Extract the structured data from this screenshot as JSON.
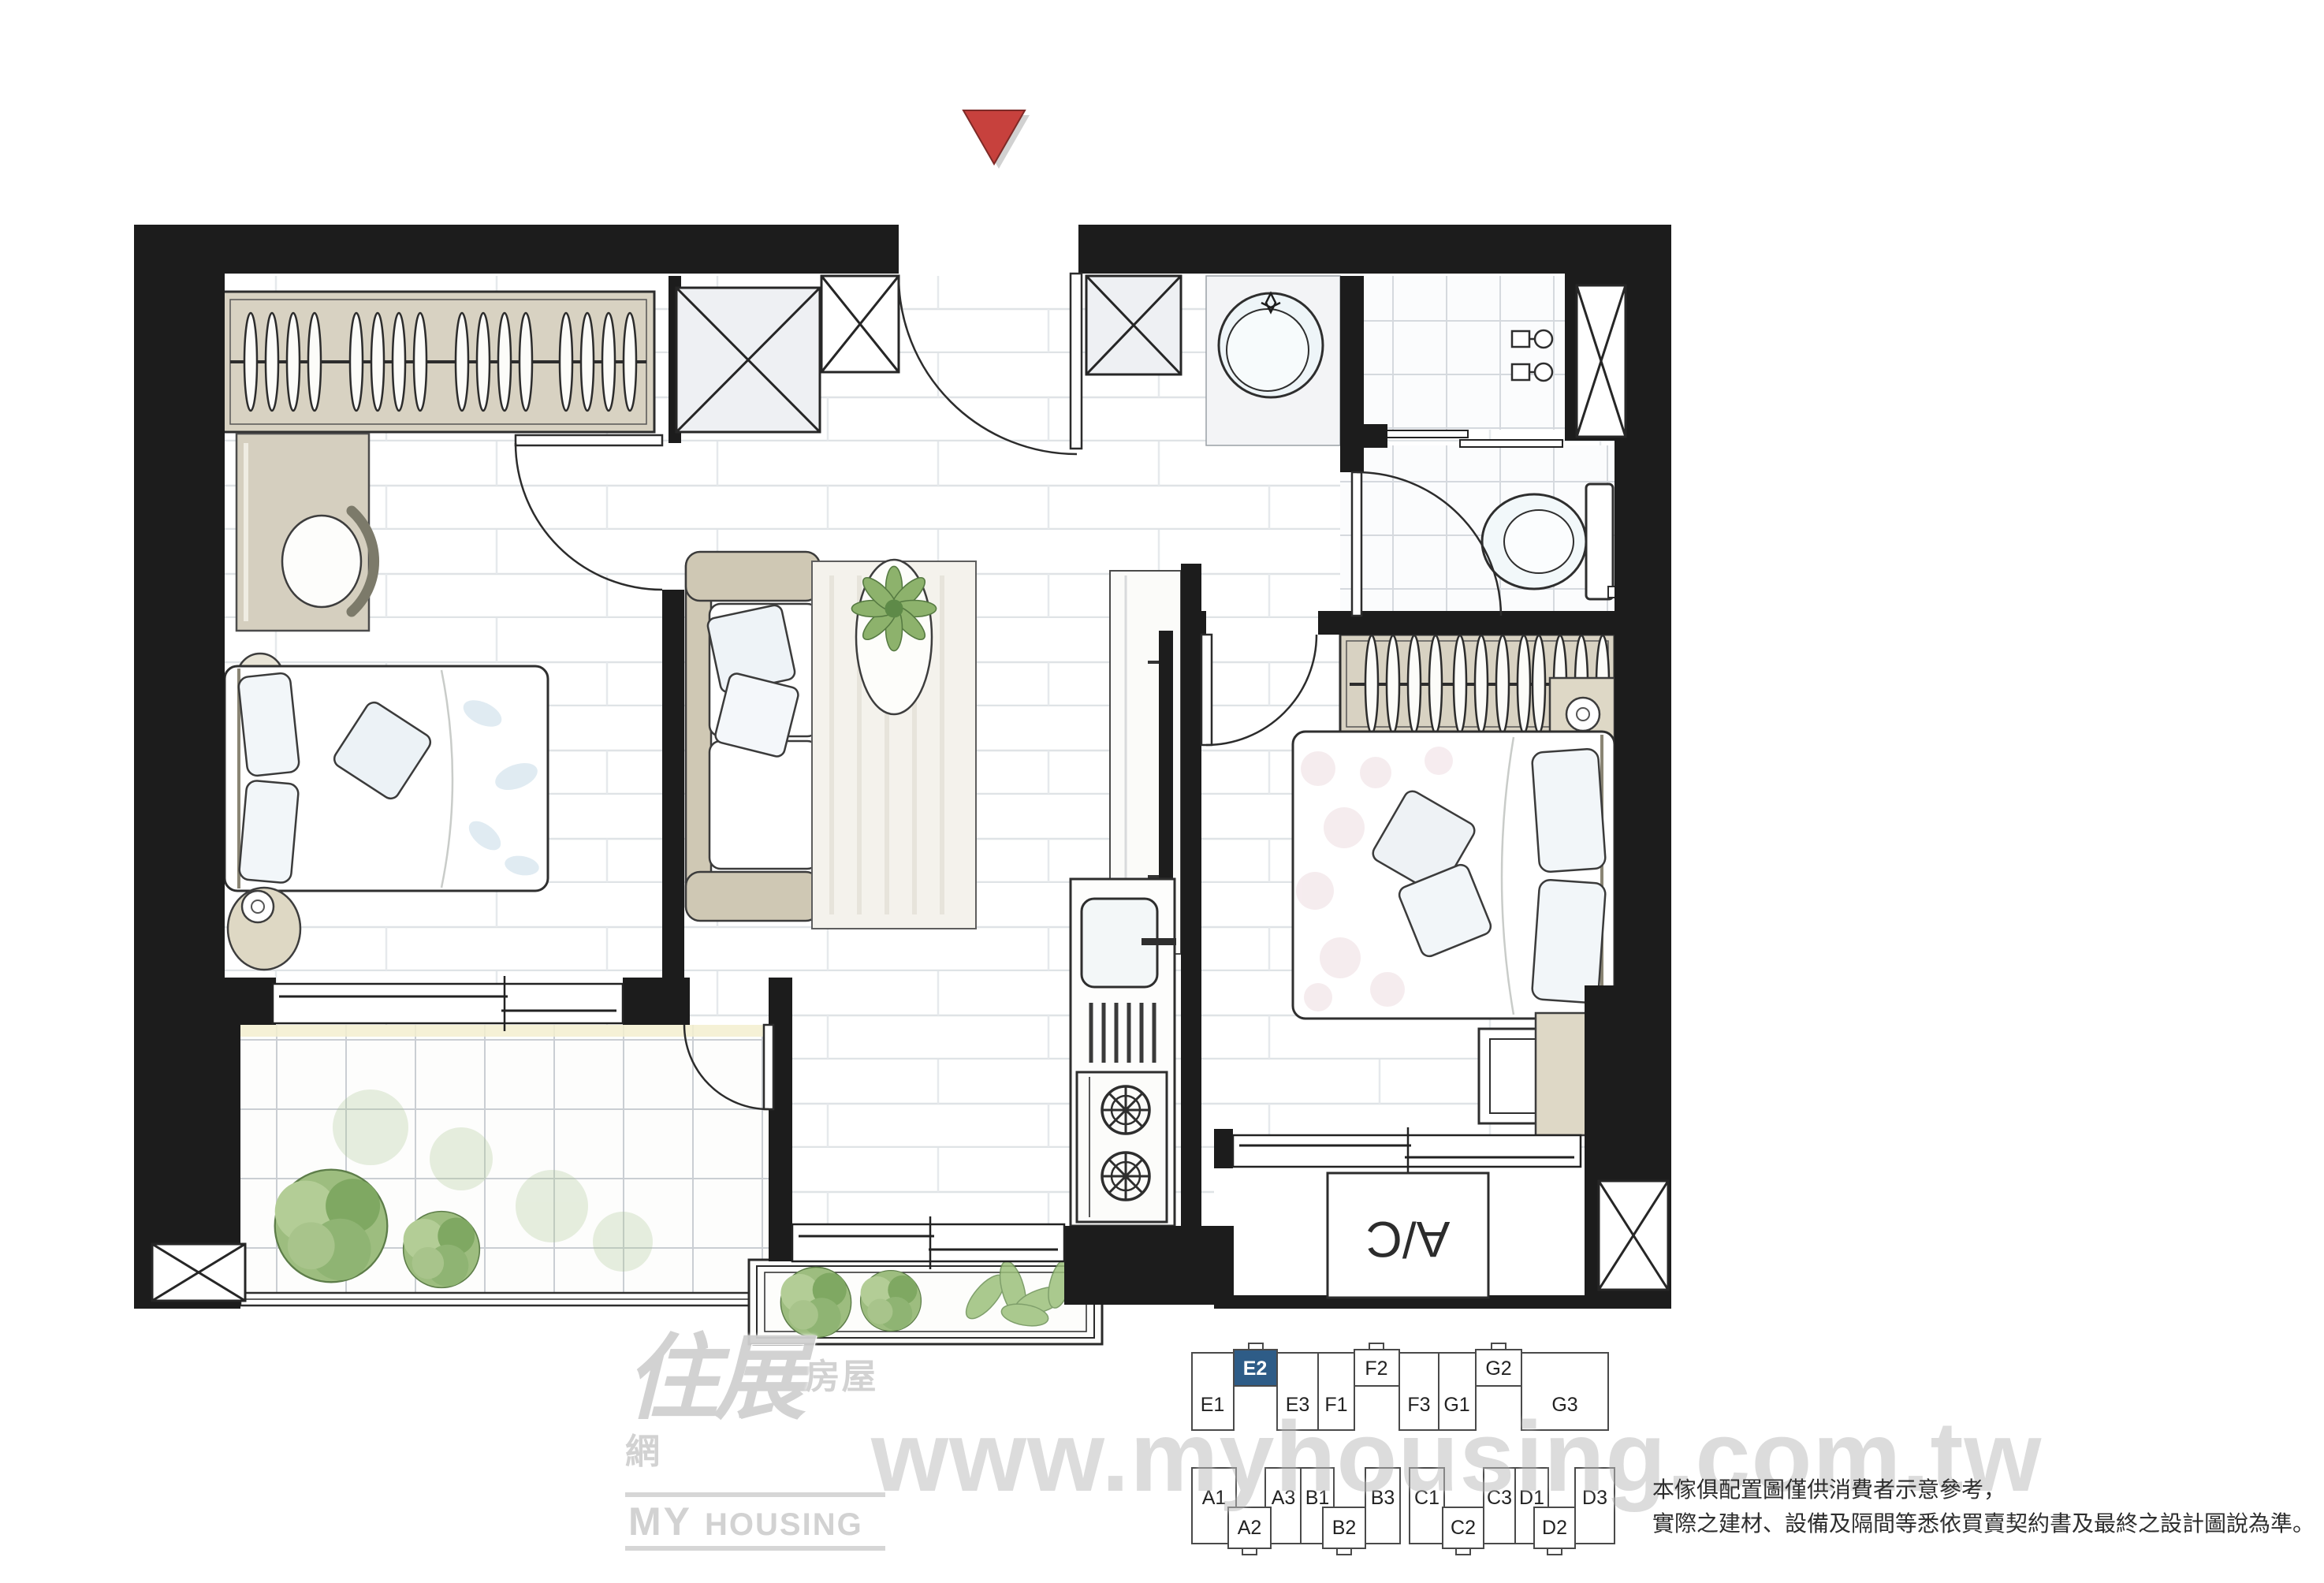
{
  "page": {
    "background": "#ffffff"
  },
  "orientation_marker": {
    "shape": "down-triangle",
    "color": "#c7413d"
  },
  "logo": {
    "cjk_main": "住展",
    "cjk_sub": "房屋網",
    "latin_my": "MY",
    "latin_housing": "HOUSING"
  },
  "watermark": {
    "text": "www.myhousing.com.tw"
  },
  "floorplan": {
    "ac_label": "A/C",
    "colors": {
      "wall": "#1c1c1c",
      "wood": "#d8d2c2",
      "plant_green": "#8db26c",
      "floor_line": "#dfe3e6"
    },
    "rooms": [
      "bedroom-1",
      "living-dining",
      "kitchen",
      "bathroom",
      "toilet",
      "bedroom-2",
      "balcony"
    ]
  },
  "keyplan": {
    "highlighted_unit": "E2",
    "highlight_color": "#2e5c87",
    "top_units": [
      "E1",
      "E2",
      "E3",
      "F1",
      "F2",
      "F3",
      "G1",
      "G2",
      "G3"
    ],
    "bottom_units": [
      "A1",
      "A2",
      "A3",
      "B1",
      "B2",
      "B3",
      "C1",
      "C2",
      "C3",
      "D1",
      "D2",
      "D3"
    ]
  },
  "disclaimer": {
    "line1": "本傢俱配置圖僅供消費者示意參考，",
    "line2": "實際之建材、設備及隔間等悉依買賣契約書及最終之設計圖說為準。"
  }
}
